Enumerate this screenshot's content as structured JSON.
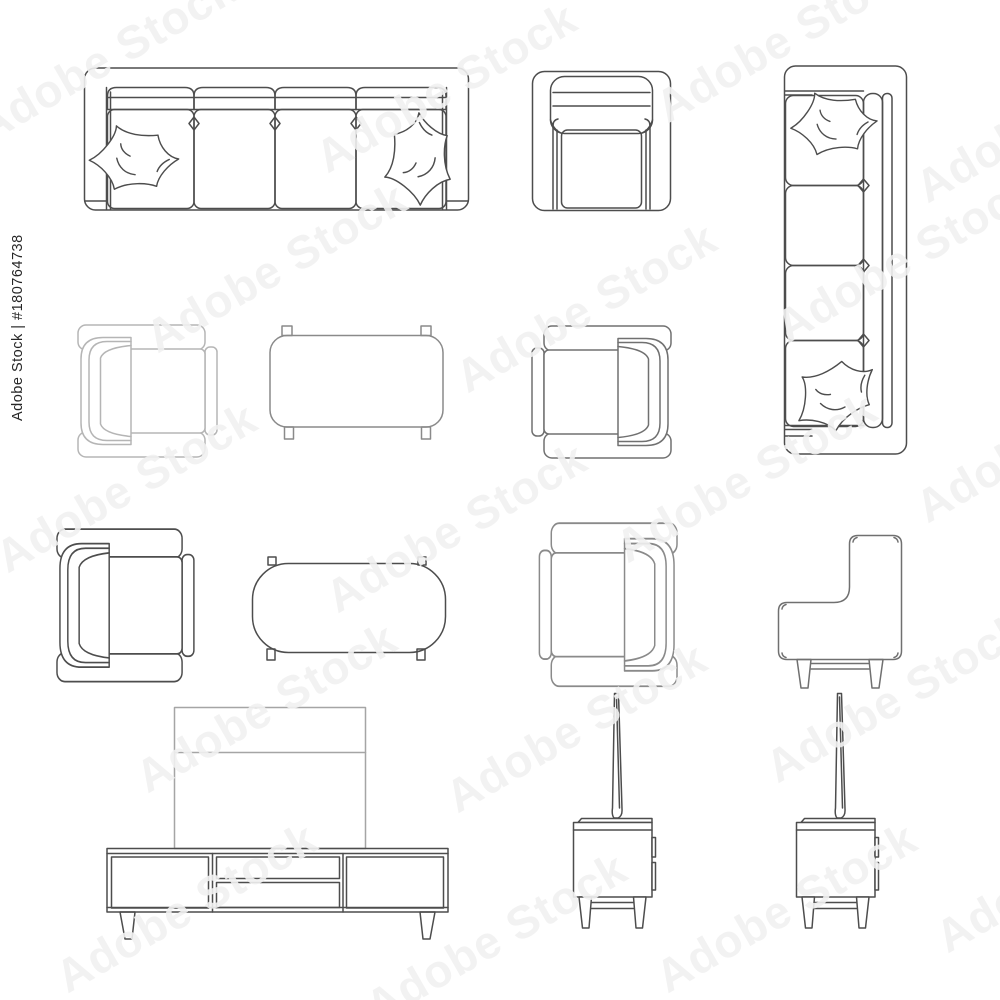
{
  "watermark": {
    "tile_text": "Adobe Stock",
    "id_text": "Adobe Stock | #180764738"
  },
  "colors": {
    "background": "#ffffff",
    "ink": "#4d4d4d",
    "ink_light": "#b5b5b5",
    "ink_medium": "#8a8a8a",
    "tv_panel": "#a5a5a5",
    "watermark_tint": "#f1f1f1",
    "id_text_color": "#262626"
  },
  "items": [
    {
      "name": "four-seat-sofa-top-view-icon",
      "label": "4-seat sofa with two pillows, top view"
    },
    {
      "name": "armchair-top-view-icon",
      "label": "Armchair, top view"
    },
    {
      "name": "long-sofa-vertical-top-view-icon",
      "label": "4-seat sofa with two pillows, top view, vertical"
    },
    {
      "name": "armchair-left-top-view-light-icon",
      "label": "Armchair facing right, top view, light outline"
    },
    {
      "name": "coffee-table-rect-top-view-icon",
      "label": "Rectangular coffee table, top view"
    },
    {
      "name": "armchair-right-top-view-icon",
      "label": "Armchair facing left, top view"
    },
    {
      "name": "armchair-left-top-view-icon",
      "label": "Armchair facing right, top view"
    },
    {
      "name": "coffee-table-rounded-top-view-icon",
      "label": "Rounded coffee table, top view"
    },
    {
      "name": "armchair-right-top-view-2-icon",
      "label": "Armchair facing left, top view"
    },
    {
      "name": "armchair-side-view-icon",
      "label": "Armchair, side view"
    },
    {
      "name": "tv-stand-front-view-icon",
      "label": "TV stand with TV, front view"
    },
    {
      "name": "tv-stand-side-view-icon",
      "label": "TV stand with TV, side view"
    },
    {
      "name": "tv-stand-side-view-2-icon",
      "label": "TV stand with TV, side view"
    }
  ]
}
